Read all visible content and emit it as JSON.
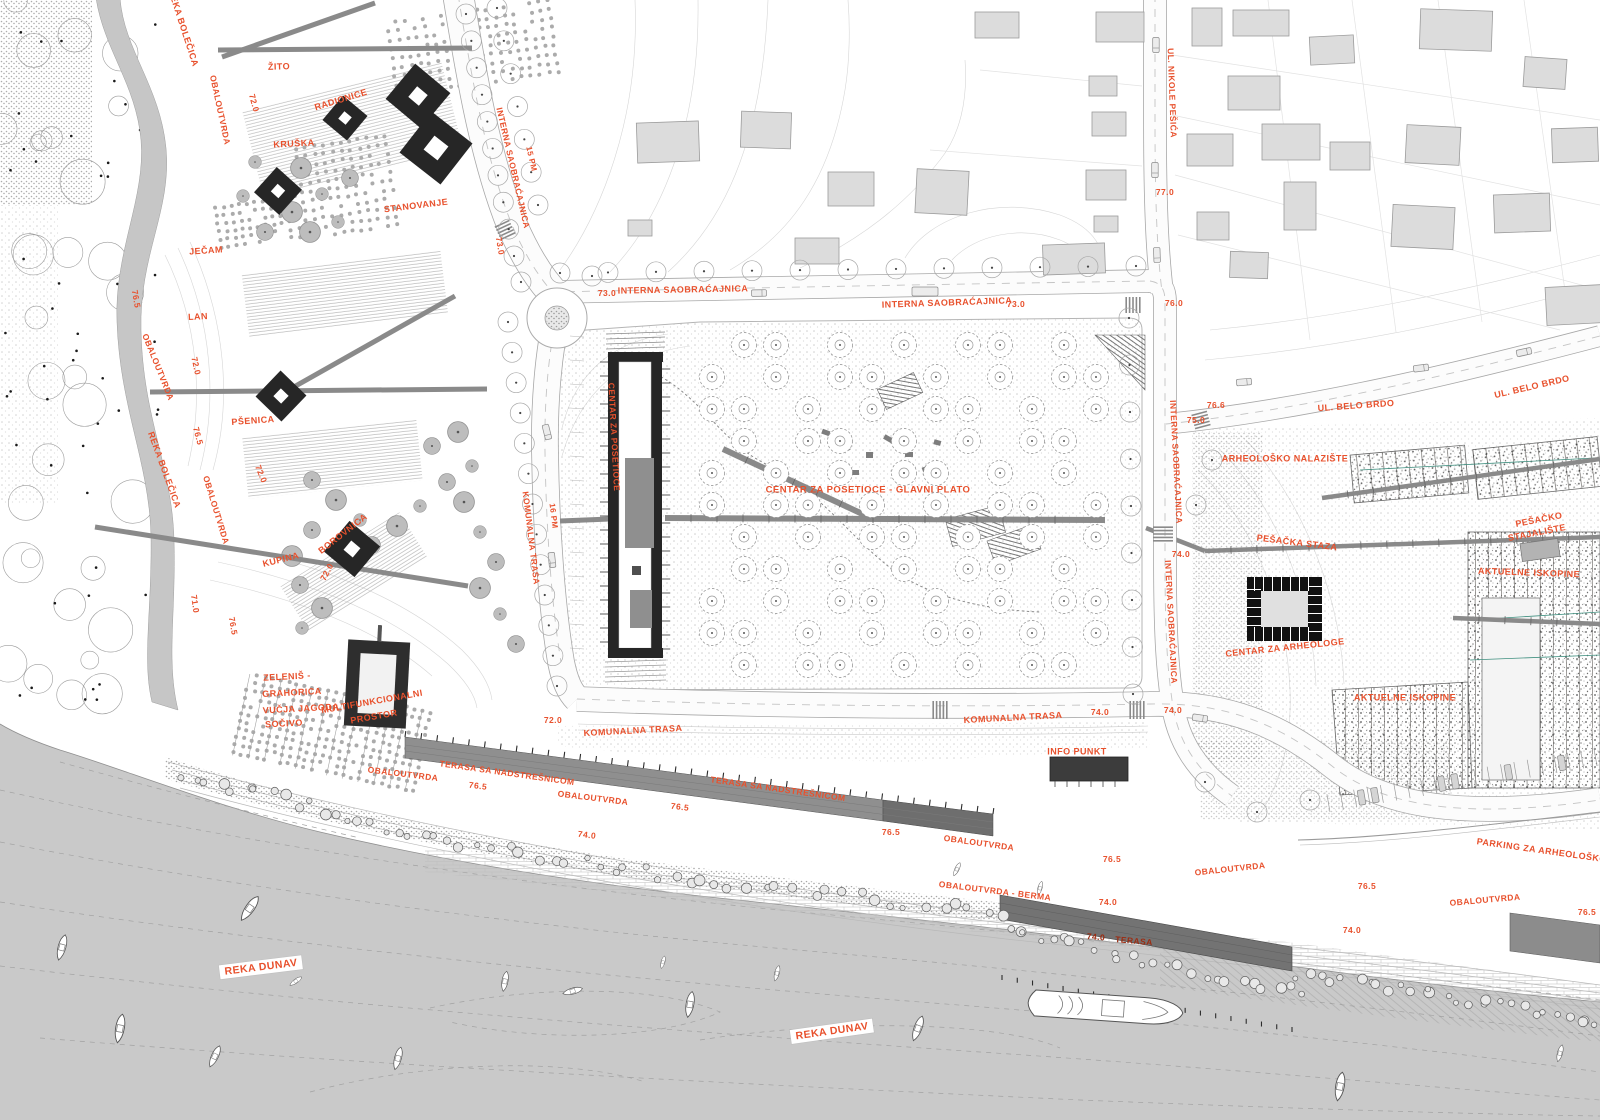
{
  "colors": {
    "accent_label": "#E8512D",
    "dark_label": "#9C2C12",
    "water": "#C9C9C9",
    "creek": "#C6C6C6",
    "terrace": "#8F8F8F",
    "terrace_dark": "#6E6E6E",
    "structure_dark": "#262626",
    "house_fill": "#DCDCDC",
    "boxed_label_bg": "#FFFFFF"
  },
  "labels": [
    {
      "t": "REKA BOLEČICA",
      "x": 183,
      "y": 28,
      "r": 72,
      "s": 9
    },
    {
      "t": "OBALOUTVRDA",
      "x": 220,
      "y": 110,
      "r": 78,
      "s": 8.5
    },
    {
      "t": "72.0",
      "x": 254,
      "y": 103,
      "r": 75,
      "s": 8.5
    },
    {
      "t": "ŽITO",
      "x": 279,
      "y": 67,
      "r": -2,
      "s": 9
    },
    {
      "t": "RADIONICE",
      "x": 341,
      "y": 100,
      "r": -17,
      "s": 9
    },
    {
      "t": "KRUŠKA",
      "x": 294,
      "y": 144,
      "r": -3,
      "s": 9
    },
    {
      "t": "STANOVANJE",
      "x": 416,
      "y": 206,
      "r": -7,
      "s": 9
    },
    {
      "t": "INTERNA SAOBRAĆAJNICA",
      "x": 513,
      "y": 168,
      "r": 77,
      "s": 8.5
    },
    {
      "t": "15 PM",
      "x": 531,
      "y": 159,
      "r": 77,
      "s": 8
    },
    {
      "t": "JEČAM",
      "x": 206,
      "y": 251,
      "r": -4,
      "s": 9
    },
    {
      "t": "76.5",
      "x": 136,
      "y": 299,
      "r": 80,
      "s": 8.5
    },
    {
      "t": "LAN",
      "x": 198,
      "y": 317,
      "r": -3,
      "s": 9
    },
    {
      "t": "OBALOUTVRDA",
      "x": 158,
      "y": 367,
      "r": 68,
      "s": 8.5
    },
    {
      "t": "72.0",
      "x": 196,
      "y": 366,
      "r": 78,
      "s": 8.5
    },
    {
      "t": "PŠENICA",
      "x": 253,
      "y": 421,
      "r": -4,
      "s": 9
    },
    {
      "t": "REKA BOLEČICA",
      "x": 164,
      "y": 470,
      "r": 70,
      "s": 9
    },
    {
      "t": "76.5",
      "x": 198,
      "y": 436,
      "r": 75,
      "s": 8.5
    },
    {
      "t": "72.0",
      "x": 261,
      "y": 474,
      "r": 68,
      "s": 8.5
    },
    {
      "t": "73.0",
      "x": 500,
      "y": 246,
      "r": 80,
      "s": 8.5
    },
    {
      "t": "OBALOUTVRDA",
      "x": 216,
      "y": 510,
      "r": 73,
      "s": 8.5
    },
    {
      "t": "71.0",
      "x": 195,
      "y": 604,
      "r": 82,
      "s": 8.5
    },
    {
      "t": "76.5",
      "x": 233,
      "y": 626,
      "r": 80,
      "s": 8.5
    },
    {
      "t": "KUPINA",
      "x": 281,
      "y": 560,
      "r": -14,
      "s": 9
    },
    {
      "t": "BOROVNICA",
      "x": 343,
      "y": 534,
      "r": -38,
      "s": 9
    },
    {
      "t": "72.0",
      "x": 327,
      "y": 572,
      "r": -62,
      "s": 8.5
    },
    {
      "t": "ZELENIŠ -",
      "x": 287,
      "y": 677,
      "r": -3,
      "s": 9
    },
    {
      "t": "GRAHORICA",
      "x": 292,
      "y": 693,
      "r": -3,
      "s": 9
    },
    {
      "t": "VUČJA JAGODA",
      "x": 301,
      "y": 709,
      "r": -3,
      "s": 9
    },
    {
      "t": "SOČIVO",
      "x": 284,
      "y": 724,
      "r": -3,
      "s": 9
    },
    {
      "t": "MULTIFUNKCIONALNI",
      "x": 372,
      "y": 702,
      "r": -10,
      "s": 9
    },
    {
      "t": "PROSTOR",
      "x": 374,
      "y": 717,
      "r": -10,
      "s": 9
    },
    {
      "t": "73.0",
      "x": 607,
      "y": 293,
      "r": 0,
      "s": 8.5
    },
    {
      "t": "INTERNA SAOBRAĆAJNICA",
      "x": 683,
      "y": 290,
      "r": -1,
      "s": 9
    },
    {
      "t": "INTERNA SAOBRAĆAJNICA",
      "x": 947,
      "y": 303,
      "r": -2,
      "s": 9
    },
    {
      "t": "73.0",
      "x": 1016,
      "y": 304,
      "r": 0,
      "s": 8.5
    },
    {
      "t": "76.0",
      "x": 1174,
      "y": 303,
      "r": 0,
      "s": 8.5
    },
    {
      "t": "UL. NIKOLE PEŠIĆA",
      "x": 1172,
      "y": 93,
      "r": 88,
      "s": 8.5
    },
    {
      "t": "77.0",
      "x": 1165,
      "y": 192,
      "r": 0,
      "s": 8.5
    },
    {
      "t": "75.0",
      "x": 1196,
      "y": 420,
      "r": 0,
      "s": 8.5
    },
    {
      "t": "76.6",
      "x": 1216,
      "y": 405,
      "r": 0,
      "s": 8.5
    },
    {
      "t": "UL. BELO BRDO",
      "x": 1356,
      "y": 406,
      "r": -4,
      "s": 9
    },
    {
      "t": "UL. BELO BRDO",
      "x": 1532,
      "y": 387,
      "r": -13,
      "s": 9
    },
    {
      "t": "INTERNA SAOBRAĆAJNICA",
      "x": 1176,
      "y": 462,
      "r": 87,
      "s": 8.5
    },
    {
      "t": "74.0",
      "x": 1181,
      "y": 554,
      "r": 0,
      "s": 8.5
    },
    {
      "t": "INTERNA SAOBRAĆAJNICA",
      "x": 1171,
      "y": 622,
      "r": 87,
      "s": 8.5
    },
    {
      "t": "ARHEOLOŠKO NALAZIŠTE",
      "x": 1285,
      "y": 459,
      "r": 0,
      "s": 9
    },
    {
      "t": "PEŠAČKA STAZA",
      "x": 1297,
      "y": 543,
      "r": 7,
      "s": 9
    },
    {
      "t": "PEŠAČKO",
      "x": 1539,
      "y": 520,
      "r": -11,
      "s": 9
    },
    {
      "t": "STAJALIŠTE",
      "x": 1537,
      "y": 533,
      "r": -11,
      "s": 9
    },
    {
      "t": "AKTUELNE ISKOPINE",
      "x": 1529,
      "y": 573,
      "r": 2,
      "s": 9
    },
    {
      "t": "CENTAR ZA ARHEOLOGE",
      "x": 1285,
      "y": 648,
      "r": -6,
      "s": 9
    },
    {
      "t": "AKTUELNE ISKOPINE",
      "x": 1405,
      "y": 698,
      "r": 0,
      "s": 9
    },
    {
      "t": "CENTAR ZA POSETIOCE",
      "x": 614,
      "y": 437,
      "r": 87,
      "s": 8.5
    },
    {
      "t": "CENTAR ZA POSETIOCE - GLAVNI PLATO",
      "x": 868,
      "y": 490,
      "r": 0,
      "s": 9.5
    },
    {
      "t": "KOMUNALNA TRASA",
      "x": 531,
      "y": 538,
      "r": 83,
      "s": 8.5
    },
    {
      "t": "16 PM",
      "x": 553,
      "y": 516,
      "r": 83,
      "s": 8
    },
    {
      "t": "72.0",
      "x": 553,
      "y": 720,
      "r": 0,
      "s": 8.5
    },
    {
      "t": "KOMUNALNA TRASA",
      "x": 633,
      "y": 731,
      "r": -3,
      "s": 9
    },
    {
      "t": "OBALOUTVRDA",
      "x": 403,
      "y": 774,
      "r": 7,
      "s": 8.5
    },
    {
      "t": "TERASA SA NADSTREŠNICOM",
      "x": 507,
      "y": 773,
      "r": 8,
      "s": 8.5
    },
    {
      "t": "76.5",
      "x": 478,
      "y": 786,
      "r": 7,
      "s": 8.5
    },
    {
      "t": "OBALOUTVRDA",
      "x": 593,
      "y": 798,
      "r": 7,
      "s": 8.5
    },
    {
      "t": "TERASA SA NADSTREŠNICOM",
      "x": 778,
      "y": 789,
      "r": 8,
      "s": 8.5
    },
    {
      "t": "76.5",
      "x": 680,
      "y": 807,
      "r": 7,
      "s": 8.5
    },
    {
      "t": "74.0",
      "x": 587,
      "y": 835,
      "r": 7,
      "s": 8.5
    },
    {
      "t": "76.5",
      "x": 891,
      "y": 832,
      "r": 0,
      "s": 8.5
    },
    {
      "t": "OBALOUTVRDA",
      "x": 979,
      "y": 843,
      "r": 8,
      "s": 8.5
    },
    {
      "t": "KOMUNALNA TRASA",
      "x": 1013,
      "y": 718,
      "r": -3,
      "s": 9
    },
    {
      "t": "74.0",
      "x": 1100,
      "y": 712,
      "r": 0,
      "s": 8.5
    },
    {
      "t": "74.0",
      "x": 1173,
      "y": 710,
      "r": 0,
      "s": 8.5
    },
    {
      "t": "INFO PUNKT",
      "x": 1077,
      "y": 752,
      "r": 0,
      "s": 9
    },
    {
      "t": "76.5",
      "x": 1112,
      "y": 859,
      "r": 0,
      "s": 8.5
    },
    {
      "t": "OBALOUTVRDA",
      "x": 1230,
      "y": 869,
      "r": -6,
      "s": 8.5
    },
    {
      "t": "OBALOUTVRDA - BERMA",
      "x": 995,
      "y": 891,
      "r": 7,
      "s": 8.5
    },
    {
      "t": "74.0",
      "x": 1108,
      "y": 902,
      "r": 0,
      "s": 8.5
    },
    {
      "t": "74.0",
      "x": 1096,
      "y": 937,
      "r": 5,
      "s": 8.5,
      "v": "d"
    },
    {
      "t": "TERASA",
      "x": 1134,
      "y": 941,
      "r": 5,
      "s": 8.5,
      "v": "d"
    },
    {
      "t": "PARKING ZA ARHEOLOŠKO NA",
      "x": 1550,
      "y": 852,
      "r": 8,
      "s": 9
    },
    {
      "t": "76.5",
      "x": 1367,
      "y": 886,
      "r": 0,
      "s": 8.5
    },
    {
      "t": "OBALOUTVRDA",
      "x": 1485,
      "y": 900,
      "r": -5,
      "s": 8.5
    },
    {
      "t": "76.5",
      "x": 1587,
      "y": 912,
      "r": 0,
      "s": 8.5
    },
    {
      "t": "74.0",
      "x": 1352,
      "y": 930,
      "r": 0,
      "s": 8.5
    },
    {
      "t": "REKA DUNAV",
      "x": 261,
      "y": 967,
      "r": -7,
      "s": 10.5,
      "v": "b"
    },
    {
      "t": "REKA DUNAV",
      "x": 832,
      "y": 1031,
      "r": -8,
      "s": 10.5,
      "v": "b"
    }
  ]
}
